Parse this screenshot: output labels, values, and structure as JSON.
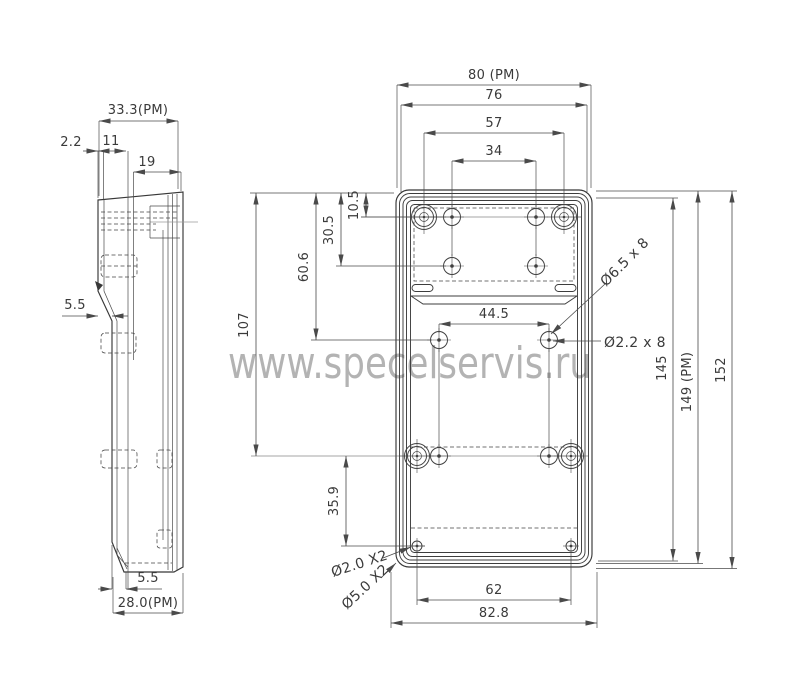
{
  "watermark": {
    "text": "www.specelservis.ru"
  },
  "colors": {
    "line": "#383838",
    "dim_line": "#4a4a4a",
    "watermark": "#b3b3b3",
    "background": "#ffffff"
  },
  "side_view": {
    "dim_overall_width": "33.3(PM)",
    "dim_lip": "2.2",
    "dim_offset": "11",
    "dim_depth": "19",
    "dim_step": "5.5",
    "dim_bottom_taper": "5.5",
    "dim_bottom_width": "28.0(PM)"
  },
  "front_view": {
    "dim_width_overall": "80 (PM)",
    "dim_width_inner": "76",
    "dim_boss_span": "57",
    "dim_hole_span": "34",
    "dim_row1": "10.5",
    "dim_row2": "30.5",
    "dim_row3": "60.6",
    "dim_row4": "107",
    "dim_mid_holes": "44.5",
    "dim_row5": "35.9",
    "dim_bottom_holes": "62",
    "dim_bottom_overall": "82.8",
    "dim_height_inner": "145",
    "dim_height_pm": "149 (PM)",
    "dim_height_overall": "152",
    "callout_boss": "Ø6.5 x 8",
    "callout_hole": "Ø2.2 x 8",
    "callout_small_hole": "Ø2.0 X2",
    "callout_corner": "Ø5.0 X2"
  }
}
